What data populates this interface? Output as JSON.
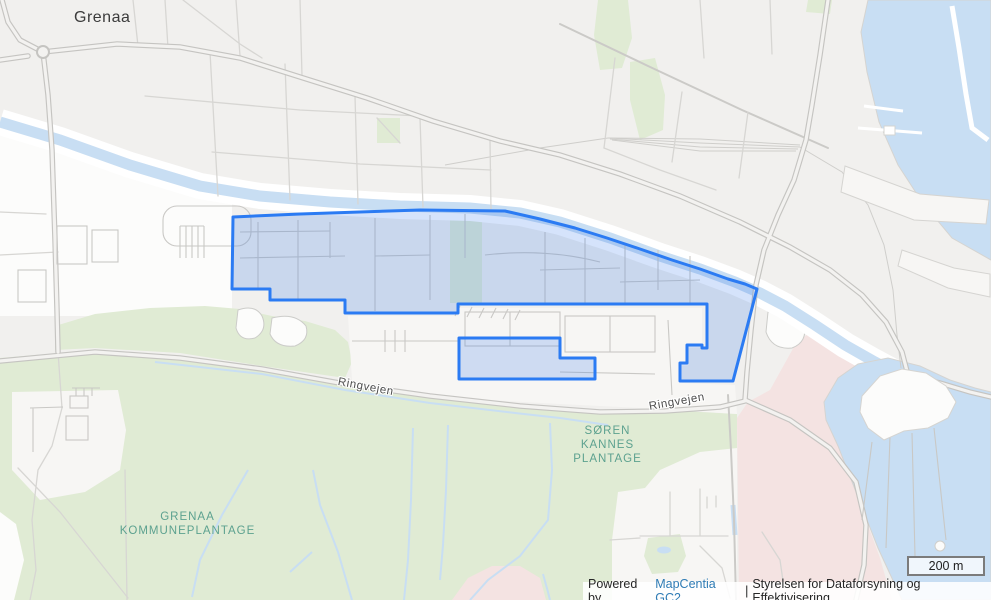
{
  "map": {
    "city_label": "Grenaa",
    "road_labels": [
      {
        "text": "Ringvejen"
      },
      {
        "text": "Ringvejen"
      }
    ],
    "area_labels": [
      {
        "id": "soren-kannes-plantage",
        "lines": [
          "SØREN",
          "KANNES",
          "PLANTAGE"
        ]
      },
      {
        "id": "grenaa-kommuneplantage",
        "lines": [
          "GRENAA",
          "KOMMUNEPLANTAGE"
        ]
      }
    ],
    "selected_features": [
      {
        "name": "highlighted-area-main"
      },
      {
        "name": "highlighted-area-small"
      }
    ]
  },
  "scalebar": {
    "label": "200 m"
  },
  "attribution": {
    "powered_by": "Powered by",
    "link_label": "MapCentia GC2",
    "separator": "|",
    "org": "Styrelsen for Dataforsyning og Effektivisering"
  },
  "colors": {
    "selection-stroke": "#2b7bf3",
    "selection-fill": "rgba(45,115,235,0.2)",
    "water": "#c8def3",
    "greenspace": "#e0ebd4",
    "urban-pink": "#f4e3e2",
    "link": "#2f7cb5",
    "area-label": "#5ca18f"
  }
}
